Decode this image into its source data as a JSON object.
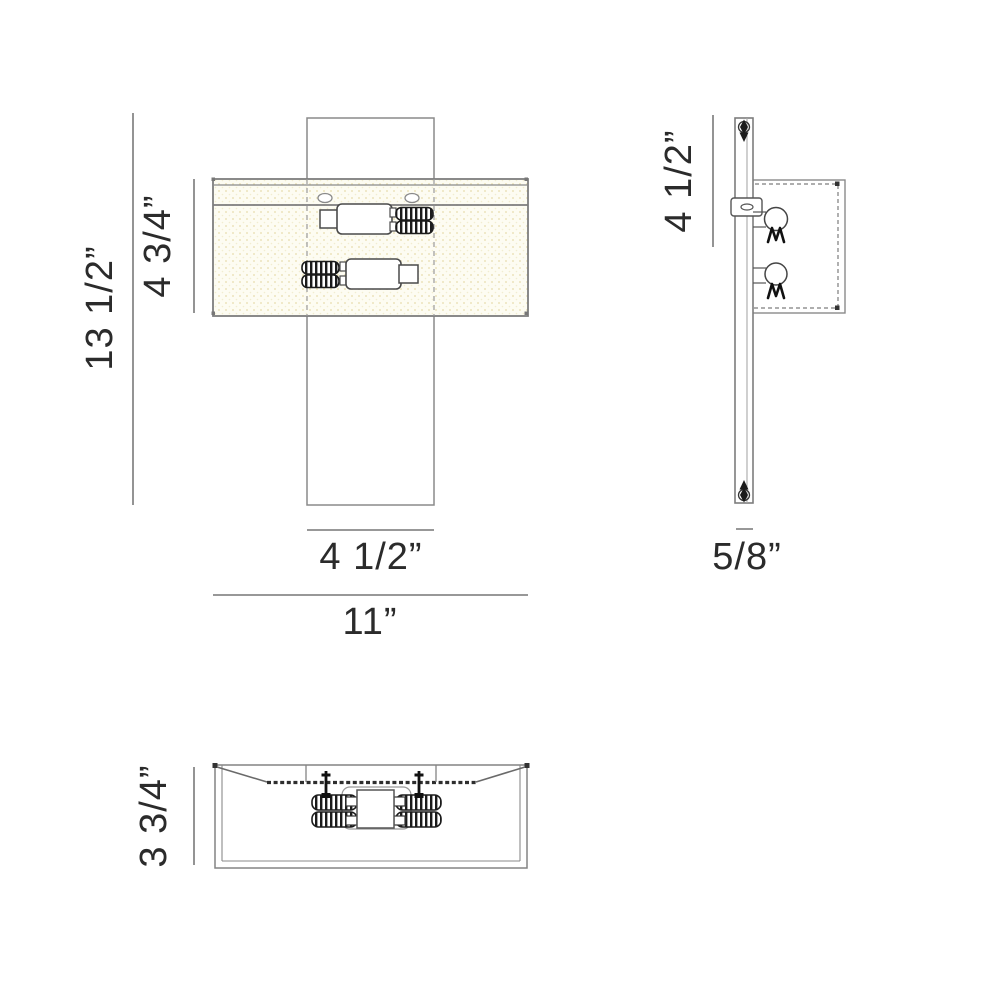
{
  "drawing": {
    "type": "technical-dimension-drawing",
    "subject": "two-light wall sconce fixture, front / side / bottom views",
    "views": {
      "front": {
        "labels": {
          "total_height": "13 1/2”",
          "shade_height": "4 3/4”",
          "backplate_width": "4 1/2”",
          "total_width": "11”"
        }
      },
      "side": {
        "labels": {
          "backplate_extension": "4 1/2”",
          "plate_thickness": "5/8”"
        }
      },
      "bottom": {
        "labels": {
          "depth": "3 3/4”"
        }
      }
    },
    "icons": [
      "screw-icon",
      "lamp-filament-symbol",
      "socket-thread-tube",
      "keyhole-slot"
    ],
    "colors": {
      "outline": "#8a8a8a",
      "dark_detail": "#1b1b1b",
      "text": "#2b2b2b",
      "shade_fill": "#fdfcf2",
      "shade_dots": "#ece4bc"
    }
  }
}
